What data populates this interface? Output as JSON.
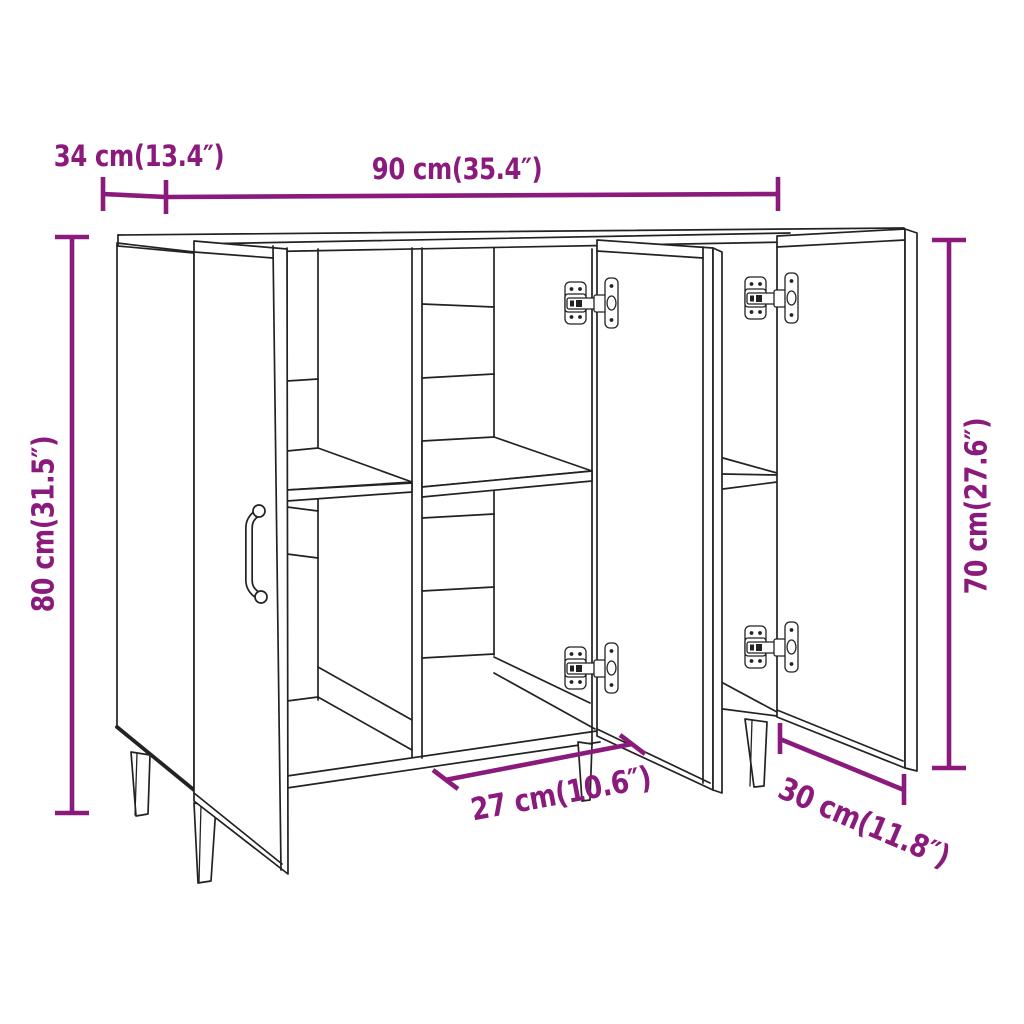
{
  "diagram": {
    "type": "product-dimension-diagram",
    "product_name": "sideboard",
    "background_color": "#FFFFFF",
    "line_color": "#222222",
    "accent_color": "#8A1A7C",
    "labels": {
      "top_depth": "34 cm(13.4″)",
      "top_width": "90 cm(35.4″)",
      "left_height": "80 cm(31.5″)",
      "right_height": "70 cm(27.6″)",
      "bottom_inner_width": "27 cm(10.6″)",
      "bottom_depth": "30 cm(11.8″)"
    }
  }
}
